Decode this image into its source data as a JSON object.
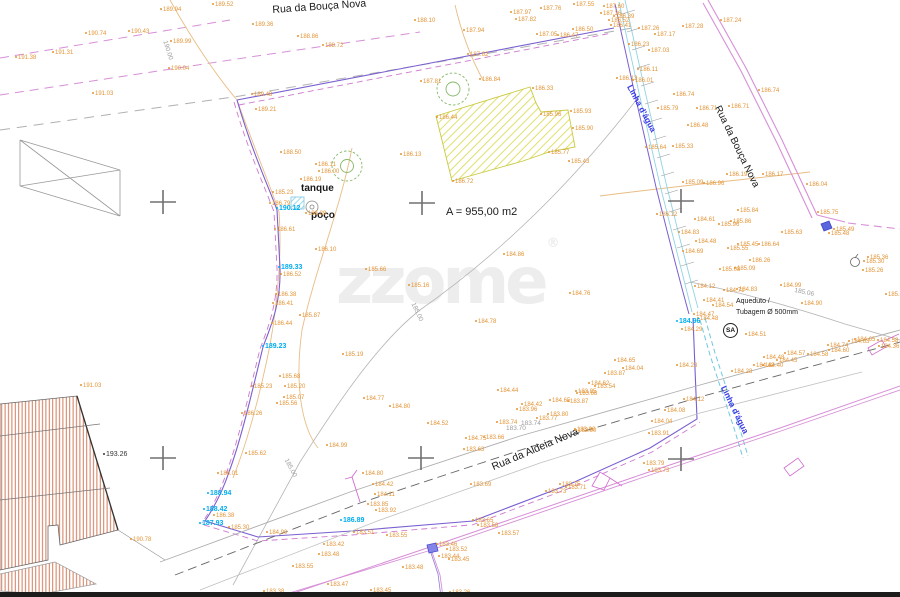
{
  "plan": {
    "street_top": "Rua da Bouça Nova",
    "street_right": "Rua da Bouça Nova",
    "street_bottom": "Rua da Aldeia Nova",
    "water_label_top": "Linha d'água",
    "water_label_bottom": "Linha d'água",
    "tank_label": "tanque",
    "well_label": "poço",
    "area_label": "A = 955,00 m2",
    "aqueduct_line1": "Aqueduto /",
    "aqueduct_line2": "Tubagem Ø 500mm",
    "sa_label": "SA"
  },
  "watermark": {
    "text": "zzome",
    "reg": "®"
  },
  "colors": {
    "elevation_label": "#E39437",
    "benchmark_label": "#00AEEF",
    "contour_label": "#9C9C9C",
    "water_text": "#3A3AE8",
    "boundary_violet": "#7A5FD0",
    "road_magenta": "#D78FD7",
    "hatch_yellow": "#D8D84A",
    "hatch_red": "#CD6B47",
    "tree_green": "#86B868",
    "stream_cyan": "#8FD4E4"
  },
  "survey_crosses": [
    [
      163,
      202
    ],
    [
      422,
      203
    ],
    [
      681,
      201
    ],
    [
      163,
      458
    ],
    [
      421,
      458
    ],
    [
      681,
      459
    ]
  ],
  "elevation_labels": [
    [
      15,
      55,
      "191.38"
    ],
    [
      52,
      50,
      "191.31"
    ],
    [
      85,
      31,
      "190.74"
    ],
    [
      128,
      29,
      "190.43"
    ],
    [
      160,
      7,
      "189.94"
    ],
    [
      212,
      2,
      "189.52"
    ],
    [
      170,
      39,
      "189.99"
    ],
    [
      168,
      66,
      "190.04"
    ],
    [
      92,
      91,
      "191.03"
    ],
    [
      280,
      150,
      "188.50"
    ],
    [
      252,
      22,
      "189.36"
    ],
    [
      297,
      34,
      "188.86"
    ],
    [
      322,
      43,
      "188.72"
    ],
    [
      414,
      18,
      "188.10"
    ],
    [
      463,
      28,
      "187.94"
    ],
    [
      510,
      10,
      "187.97"
    ],
    [
      515,
      17,
      "187.82"
    ],
    [
      467,
      52,
      "187.62"
    ],
    [
      420,
      79,
      "187.81"
    ],
    [
      479,
      77,
      "186.84"
    ],
    [
      251,
      92,
      "189.48"
    ],
    [
      255,
      107,
      "189.21"
    ],
    [
      540,
      6,
      "187.76"
    ],
    [
      573,
      2,
      "187.55"
    ],
    [
      603,
      4,
      "187.60"
    ],
    [
      600,
      11,
      "187.36"
    ],
    [
      613,
      14,
      "186.39"
    ],
    [
      608,
      18,
      "186.52"
    ],
    [
      610,
      23,
      "186.41"
    ],
    [
      572,
      27,
      "186.50"
    ],
    [
      536,
      32,
      "187.05"
    ],
    [
      557,
      33,
      "186.47"
    ],
    [
      628,
      42,
      "186.23"
    ],
    [
      638,
      26,
      "187.26"
    ],
    [
      654,
      32,
      "187.17"
    ],
    [
      682,
      24,
      "187.28"
    ],
    [
      720,
      18,
      "187.24"
    ],
    [
      648,
      48,
      "187.03"
    ],
    [
      637,
      67,
      "186.11"
    ],
    [
      616,
      76,
      "186.13"
    ],
    [
      632,
      78,
      "186.01"
    ],
    [
      673,
      92,
      "186.74"
    ],
    [
      657,
      106,
      "185.79"
    ],
    [
      696,
      106,
      "186.71"
    ],
    [
      728,
      104,
      "186.71"
    ],
    [
      758,
      88,
      "186.74"
    ],
    [
      687,
      123,
      "186.48"
    ],
    [
      672,
      144,
      "185.33"
    ],
    [
      645,
      145,
      "185.64"
    ],
    [
      532,
      86,
      "186.33"
    ],
    [
      436,
      115,
      "186.44"
    ],
    [
      570,
      109,
      "185.93"
    ],
    [
      540,
      112,
      "185.96"
    ],
    [
      572,
      126,
      "185.90"
    ],
    [
      548,
      150,
      "185.77"
    ],
    [
      568,
      159,
      "185.43"
    ],
    [
      452,
      179,
      "186.72"
    ],
    [
      400,
      152,
      "186.13"
    ],
    [
      276,
      206,
      "190.12",
      "c"
    ],
    [
      278,
      265,
      "189.33",
      "c"
    ],
    [
      262,
      344,
      "189.23",
      "c"
    ],
    [
      315,
      162,
      "186.11"
    ],
    [
      318,
      169,
      "186.00"
    ],
    [
      300,
      177,
      "186.19"
    ],
    [
      272,
      190,
      "185.23"
    ],
    [
      269,
      201,
      "186.79"
    ],
    [
      305,
      211,
      "186.39"
    ],
    [
      274,
      227,
      "186.61"
    ],
    [
      315,
      247,
      "186.10"
    ],
    [
      280,
      272,
      "186.52"
    ],
    [
      275,
      292,
      "186.38"
    ],
    [
      272,
      301,
      "186.41"
    ],
    [
      271,
      321,
      "186.44"
    ],
    [
      299,
      313,
      "185.87"
    ],
    [
      365,
      267,
      "185.66"
    ],
    [
      408,
      283,
      "185.16"
    ],
    [
      503,
      252,
      "184.86"
    ],
    [
      569,
      291,
      "184.76"
    ],
    [
      475,
      319,
      "184.78"
    ],
    [
      342,
      352,
      "185.19"
    ],
    [
      279,
      374,
      "185.68"
    ],
    [
      284,
      384,
      "185.20"
    ],
    [
      283,
      395,
      "185.07"
    ],
    [
      276,
      401,
      "185.56"
    ],
    [
      251,
      384,
      "185.23"
    ],
    [
      241,
      411,
      "186.26"
    ],
    [
      326,
      443,
      "184.99"
    ],
    [
      363,
      396,
      "184.77"
    ],
    [
      389,
      404,
      "184.80"
    ],
    [
      245,
      451,
      "185.62"
    ],
    [
      217,
      471,
      "186.01"
    ],
    [
      207,
      491,
      "188.94",
      "c"
    ],
    [
      203,
      507,
      "188.42",
      "c"
    ],
    [
      213,
      513,
      "186.38"
    ],
    [
      199,
      521,
      "187.93",
      "c"
    ],
    [
      228,
      525,
      "185.30"
    ],
    [
      266,
      530,
      "184.90"
    ],
    [
      340,
      518,
      "186.89",
      "c"
    ],
    [
      80,
      383,
      "191.03"
    ],
    [
      130,
      537,
      "190.78"
    ],
    [
      103,
      452,
      "193.26",
      "b"
    ],
    [
      362,
      471,
      "184.80"
    ],
    [
      372,
      482,
      "184.42"
    ],
    [
      374,
      492,
      "184.11"
    ],
    [
      367,
      502,
      "183.85"
    ],
    [
      375,
      508,
      "183.92"
    ],
    [
      353,
      530,
      "183.51"
    ],
    [
      386,
      533,
      "183.55"
    ],
    [
      323,
      542,
      "183.42"
    ],
    [
      318,
      552,
      "183.48"
    ],
    [
      263,
      589,
      "183.38"
    ],
    [
      292,
      564,
      "183.55"
    ],
    [
      327,
      582,
      "183.47"
    ],
    [
      370,
      588,
      "183.45"
    ],
    [
      402,
      565,
      "183.48"
    ],
    [
      436,
      542,
      "183.46"
    ],
    [
      446,
      547,
      "183.52"
    ],
    [
      438,
      554,
      "183.44"
    ],
    [
      448,
      557,
      "183.45"
    ],
    [
      449,
      590,
      "183.26"
    ],
    [
      497,
      388,
      "184.44"
    ],
    [
      427,
      421,
      "184.52"
    ],
    [
      521,
      402,
      "184.42"
    ],
    [
      516,
      407,
      "183.96"
    ],
    [
      496,
      420,
      "183.74"
    ],
    [
      536,
      416,
      "183.77"
    ],
    [
      547,
      412,
      "183.80"
    ],
    [
      567,
      399,
      "183.87"
    ],
    [
      576,
      391,
      "183.68"
    ],
    [
      549,
      398,
      "184.65"
    ],
    [
      574,
      427,
      "183.90"
    ],
    [
      465,
      436,
      "184.75"
    ],
    [
      483,
      435,
      "183.66"
    ],
    [
      463,
      447,
      "183.63"
    ],
    [
      470,
      482,
      "183.69"
    ],
    [
      477,
      523,
      "183.58"
    ],
    [
      472,
      518,
      "183.65"
    ],
    [
      498,
      531,
      "183.57"
    ],
    [
      506,
      426,
      "183.70",
      "g"
    ],
    [
      521,
      421,
      "183.74",
      "g"
    ],
    [
      565,
      485,
      "183.71"
    ],
    [
      559,
      482,
      "183.75"
    ],
    [
      545,
      489,
      "183.73"
    ],
    [
      643,
      461,
      "183.79"
    ],
    [
      648,
      468,
      "183.73"
    ],
    [
      676,
      363,
      "184.23"
    ],
    [
      683,
      397,
      "184.12"
    ],
    [
      664,
      408,
      "184.08"
    ],
    [
      651,
      419,
      "184.04"
    ],
    [
      648,
      431,
      "183.91"
    ],
    [
      575,
      428,
      "183.90"
    ],
    [
      614,
      358,
      "184.65"
    ],
    [
      622,
      366,
      "184.04"
    ],
    [
      604,
      371,
      "183.87"
    ],
    [
      594,
      384,
      "183.54"
    ],
    [
      575,
      389,
      "183.85"
    ],
    [
      588,
      381,
      "184.62"
    ],
    [
      827,
      343,
      "184.74"
    ],
    [
      828,
      348,
      "184.60"
    ],
    [
      848,
      339,
      "184.63"
    ],
    [
      854,
      337,
      "184.65"
    ],
    [
      877,
      338,
      "184.58"
    ],
    [
      878,
      344,
      "184.36"
    ],
    [
      784,
      351,
      "184.57"
    ],
    [
      807,
      352,
      "184.58"
    ],
    [
      776,
      358,
      "184.45"
    ],
    [
      763,
      355,
      "184.48"
    ],
    [
      762,
      363,
      "184.40"
    ],
    [
      753,
      363,
      "184.42"
    ],
    [
      731,
      369,
      "184.28"
    ],
    [
      885,
      292,
      "185.28"
    ],
    [
      801,
      301,
      "184.90"
    ],
    [
      867,
      255,
      "185.36"
    ],
    [
      863,
      259,
      "185.30"
    ],
    [
      862,
      268,
      "185.26"
    ],
    [
      694,
      217,
      "184.61"
    ],
    [
      656,
      212,
      "186.12"
    ],
    [
      678,
      230,
      "184.83"
    ],
    [
      695,
      239,
      "184.48"
    ],
    [
      737,
      242,
      "185.45"
    ],
    [
      727,
      246,
      "185.55"
    ],
    [
      758,
      242,
      "186.64"
    ],
    [
      682,
      249,
      "184.69"
    ],
    [
      749,
      258,
      "186.26"
    ],
    [
      719,
      267,
      "185.08"
    ],
    [
      734,
      266,
      "185.09"
    ],
    [
      694,
      284,
      "184.12"
    ],
    [
      723,
      288,
      "184.71"
    ],
    [
      736,
      287,
      "184.83"
    ],
    [
      780,
      283,
      "184.99"
    ],
    [
      703,
      298,
      "184.41"
    ],
    [
      712,
      303,
      "184.54"
    ],
    [
      693,
      312,
      "184.47"
    ],
    [
      697,
      316,
      "184.48"
    ],
    [
      676,
      319,
      "184.96",
      "c"
    ],
    [
      681,
      327,
      "184.29"
    ],
    [
      745,
      332,
      "184.51"
    ],
    [
      682,
      180,
      "185.09"
    ],
    [
      703,
      181,
      "186.96"
    ],
    [
      737,
      208,
      "185.84"
    ],
    [
      730,
      219,
      "185.86"
    ],
    [
      718,
      222,
      "185.96"
    ],
    [
      806,
      182,
      "186.04"
    ],
    [
      817,
      210,
      "185.75"
    ],
    [
      833,
      227,
      "185.49"
    ],
    [
      828,
      231,
      "185.48"
    ],
    [
      781,
      230,
      "185.63"
    ],
    [
      726,
      172,
      "186.19"
    ],
    [
      762,
      172,
      "186.17"
    ],
    [
      167,
      40,
      "190.00",
      "g",
      72
    ],
    [
      415,
      302,
      "185.00",
      "g",
      65
    ],
    [
      288,
      458,
      "185.00",
      "g",
      62
    ],
    [
      795,
      288,
      "185.06",
      "g",
      12
    ]
  ]
}
